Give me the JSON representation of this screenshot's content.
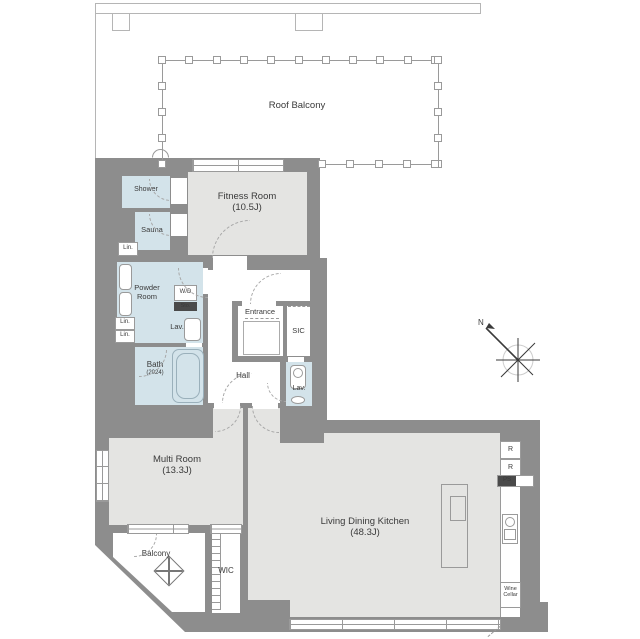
{
  "colors": {
    "wall": "#8d8d8d",
    "floor": "#e4e4e2",
    "wet": "#d3e3ea",
    "line": "#9a9a9a",
    "ink": "#3a3a3a"
  },
  "rooms": {
    "roof_balcony": {
      "name": "Roof Balcony"
    },
    "fitness": {
      "name": "Fitness Room",
      "size": "(10.5J)"
    },
    "shower": {
      "name": "Shower"
    },
    "sauna": {
      "name": "Sauna"
    },
    "powder": {
      "name": "Powder Room"
    },
    "bath": {
      "name": "Bath",
      "size": "(2024)"
    },
    "hall": {
      "name": "Hall"
    },
    "entrance": {
      "name": "Entrance"
    },
    "sic": {
      "name": "SIC"
    },
    "lavatory": {
      "name": "Lav."
    },
    "toilet": {
      "name": "Lav."
    },
    "multi": {
      "name": "Multi Room",
      "size": "(13.3J)"
    },
    "balcony": {
      "name": "Balcony"
    },
    "wic": {
      "name": "WIC"
    },
    "ldk": {
      "name": "Living Dining Kitchen",
      "size": "(48.3J)"
    }
  },
  "fixtures": {
    "washer_dryer": "W/D",
    "storage": "Sto.",
    "linen": "Lin.",
    "refrigerator": "R",
    "pipe_space": "PS",
    "wine_cellar": "Wine Cellar"
  },
  "compass": {
    "north": "N"
  }
}
